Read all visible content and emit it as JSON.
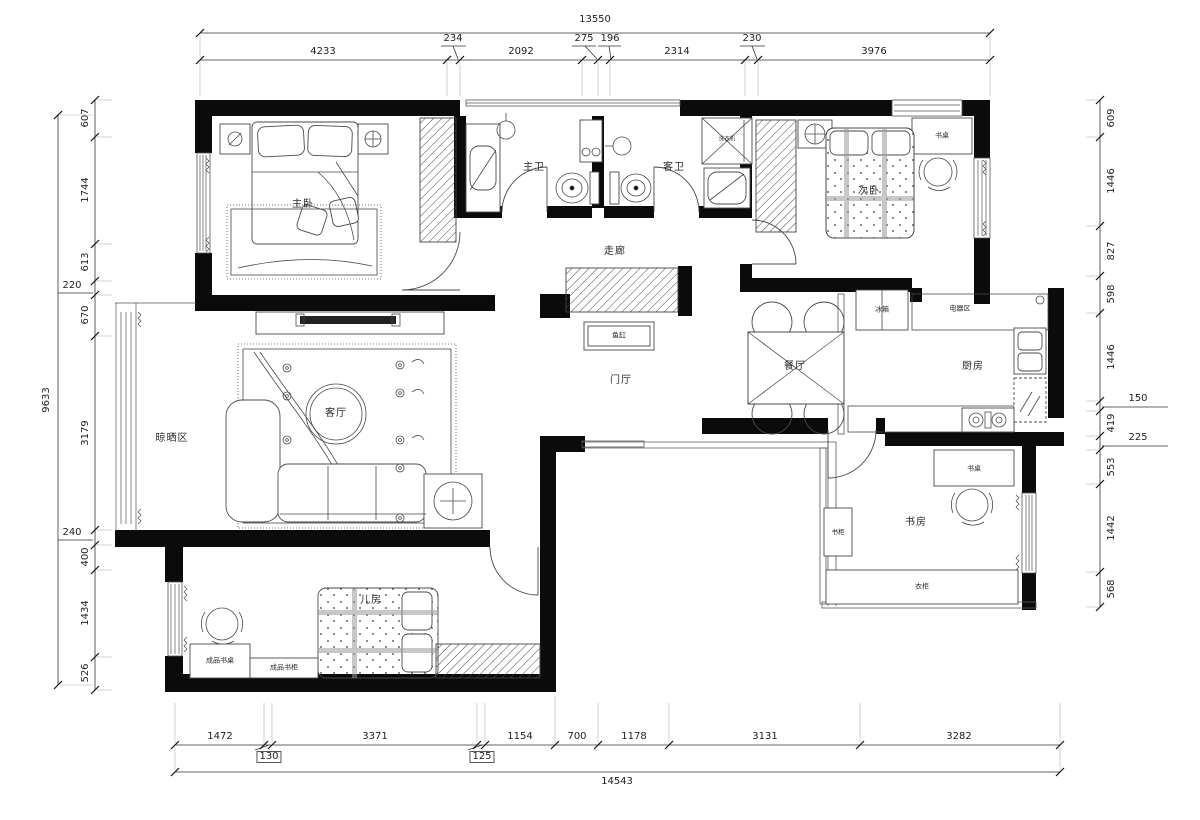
{
  "title": "apartment-floor-plan",
  "colors": {
    "wall": "#0b0b0b",
    "furniture_line": "#4a4a4a",
    "dimension_text": "#1e1e1e"
  },
  "rooms": {
    "master_bedroom": "主卧",
    "master_bath": "主卫",
    "guest_bath": "客卫",
    "second_bedroom": "次卧",
    "corridor": "走廊",
    "foyer": "门厅",
    "living_room": "客厅",
    "dining_room": "餐厅",
    "kitchen": "厨房",
    "study": "书房",
    "kids_room": "儿房",
    "drying_area": "晾晒区"
  },
  "features": {
    "fish_tank": "鱼缸",
    "fridge": "冰箱",
    "appliance_area": "电器区",
    "washing_machine": "洗衣机",
    "desk_bedroom": "书桌",
    "desk_study": "书桌",
    "bookcase": "书柜",
    "wardrobe": "衣柜",
    "ready_desk": "成品书桌",
    "ready_bookcase": "成品书柜"
  },
  "dims": {
    "top": {
      "overall": "13550",
      "segments": [
        "4233",
        "234",
        "2092",
        "275",
        "196",
        "2314",
        "230",
        "3976"
      ]
    },
    "bottom": {
      "overall": "14543",
      "segments": [
        "1472",
        "130",
        "3371",
        "125",
        "1154",
        "700",
        "1178",
        "3131",
        "3282"
      ]
    },
    "left": {
      "overall": "9633",
      "segments": [
        "607",
        "1744",
        "613",
        "220",
        "670",
        "3179",
        "240",
        "400",
        "1434",
        "526"
      ]
    },
    "right": {
      "segments": [
        "609",
        "1446",
        "827",
        "598",
        "1446",
        "150",
        "419",
        "225",
        "553",
        "1442",
        "568"
      ]
    }
  }
}
